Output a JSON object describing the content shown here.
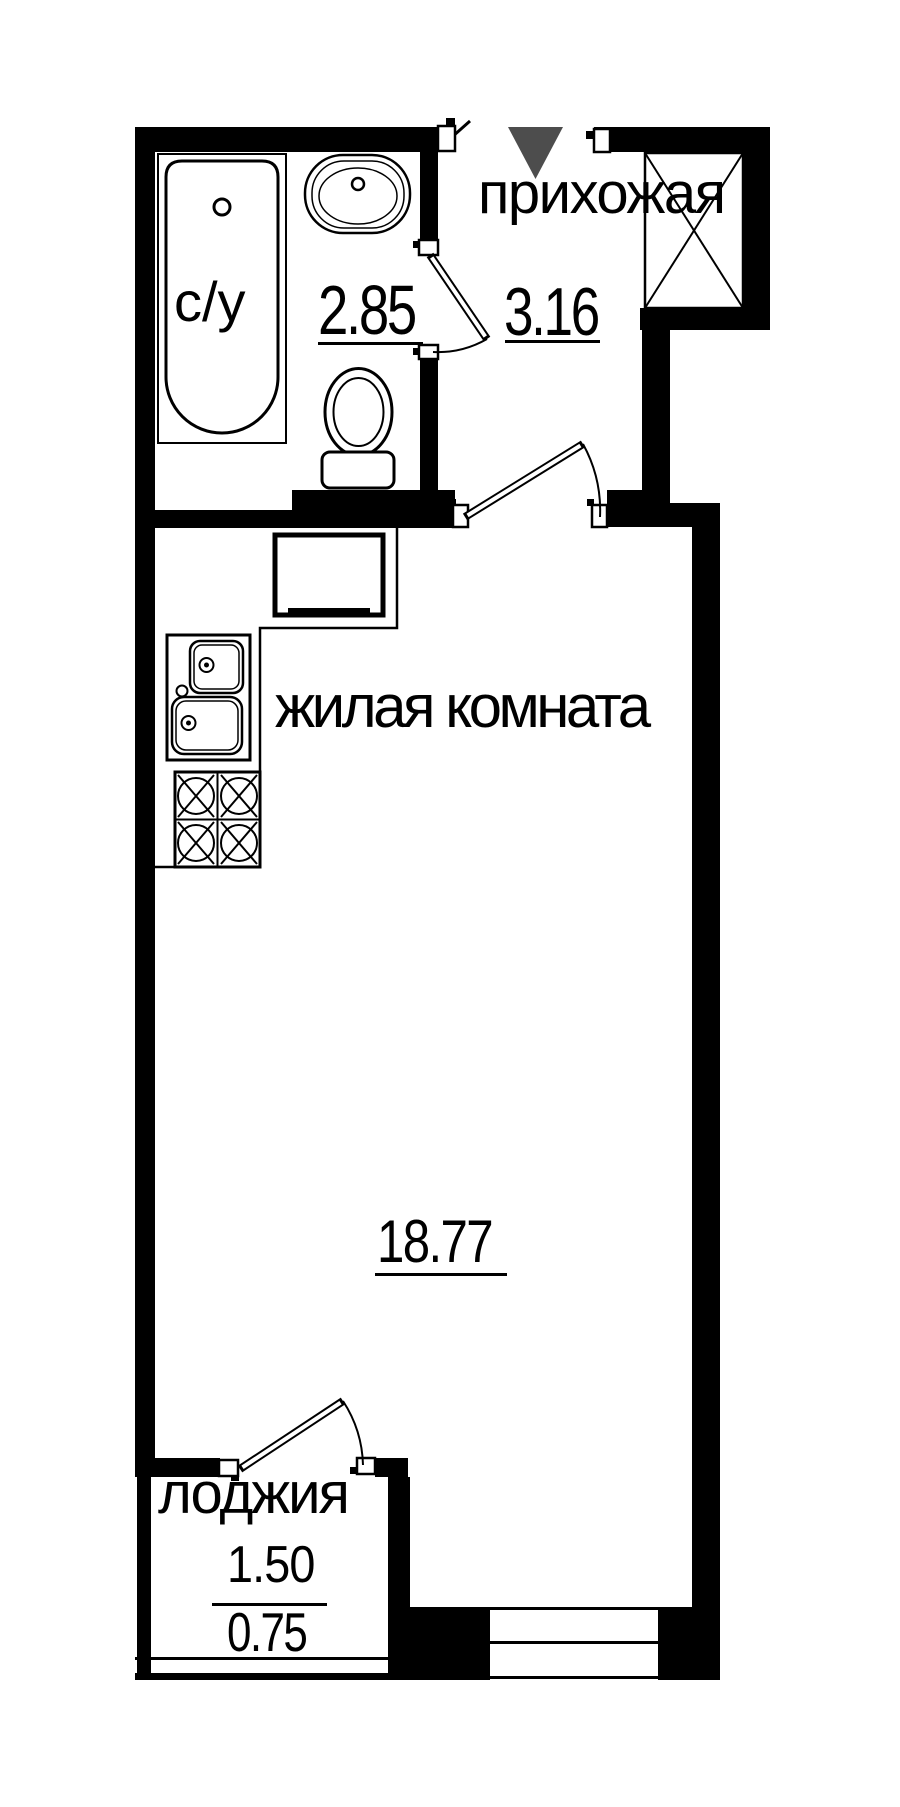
{
  "rooms": {
    "hallway": {
      "name": "прихожая",
      "area": "3.16"
    },
    "bathroom": {
      "name": "с/у",
      "area": "2.85"
    },
    "living": {
      "name": "жилая комната",
      "area": "18.77"
    },
    "loggia": {
      "name": "лоджия",
      "area_full": "1.50",
      "area_reduced": "0.75"
    }
  },
  "colors": {
    "walls": "#000000",
    "background": "#ffffff",
    "entrance_marker": "#4d4d4d"
  },
  "fixtures": [
    "bathtub",
    "washbasin",
    "toilet",
    "kitchen-sink",
    "stove",
    "refrigerator",
    "ventilation-shaft",
    "entrance-arrow",
    "interior-door",
    "balcony-door",
    "window",
    "loggia-glazing"
  ]
}
